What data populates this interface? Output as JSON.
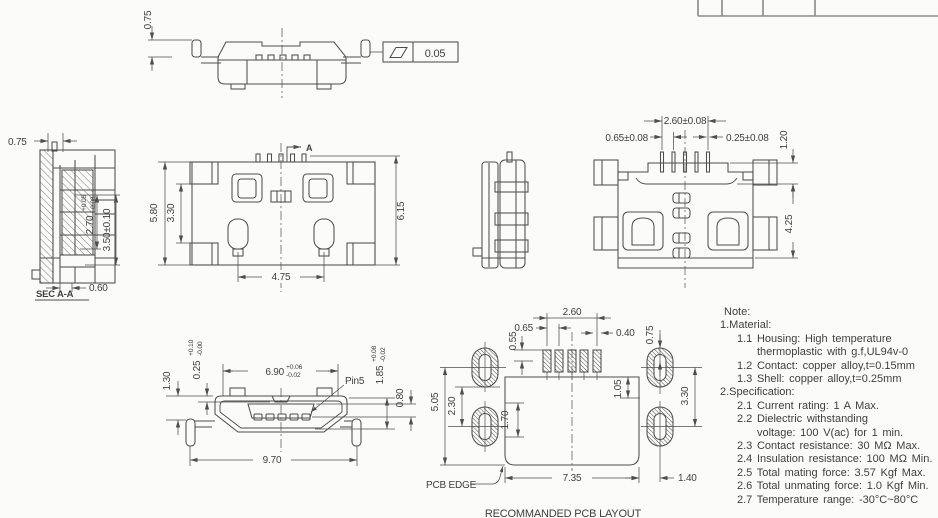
{
  "colors": {
    "background": "#fbfbfa",
    "line": "#4e4e4e",
    "text": "#3f3f3f"
  },
  "views": {
    "front_elevation": {
      "dim_leg_height": "0.75",
      "flatness_value": "0.05"
    },
    "section_aa": {
      "label": "SEC A-A",
      "dim_pin_offset": "0.75",
      "depth": {
        "base": "2.70",
        "plus": "+0.05",
        "minus": "-0.08"
      },
      "dim_height": "3.50±0.10",
      "dim_foot": "0.60"
    },
    "top_view": {
      "section_label": "A",
      "dim_shell_width": "5.80",
      "dim_tab_span": "3.30",
      "dim_overall_depth": "6.15",
      "dim_peg_pitch": "4.75"
    },
    "bottom_view": {
      "dim_pin_span": "2.60±0.08",
      "dim_pin_pitch": "0.65±0.08",
      "dim_pin_width": "0.25±0.08",
      "dim_front_step": "1.20",
      "dim_body_depth": "4.25"
    },
    "front_view": {
      "dim_leg_drop": "1.30",
      "dimple": {
        "base": "0.25",
        "plus": "+0.10",
        "minus": "-0.00"
      },
      "opening": {
        "base": "6.90",
        "plus": "+0.06",
        "minus": "-0.02"
      },
      "pin_label": "Pin5",
      "tongue": {
        "base": "1.85",
        "plus": "+0.08",
        "minus": "-0.02"
      },
      "dim_tongue_height": "0.80",
      "dim_overall_width": "9.70"
    },
    "pcb_layout": {
      "caption": "RECOMMANDED PCB LAYOUT",
      "edge_label": "PCB EDGE",
      "dim_pad_span": "2.60",
      "dim_pad_pitch": "0.65",
      "dim_pad_width": "0.40",
      "dim_pad_inset": "0.55",
      "dim_pad_edge": "0.75",
      "dim_left_span": "5.05",
      "dim_hole_inset": "2.30",
      "dim_cutout_depth": "1.70",
      "dim_pad_row_edge": "1.05",
      "dim_hole_span": "3.30",
      "dim_cutout_width": "7.35",
      "dim_hole_edge": "1.40"
    }
  },
  "notes": {
    "heading": "Note:",
    "lines": [
      {
        "indent": 0,
        "text": "1.Material:"
      },
      {
        "indent": 1,
        "text": "1.1 Housing: High temperature"
      },
      {
        "indent": 2,
        "text": "thermoplastic with g.f,UL94v-0"
      },
      {
        "indent": 1,
        "text": "1.2 Contact: copper alloy,t=0.15mm"
      },
      {
        "indent": 1,
        "text": "1.3 Shell: copper alloy,t=0.25mm"
      },
      {
        "indent": 0,
        "text": "2.Specification:"
      },
      {
        "indent": 1,
        "text": "2.1 Current rating: 1 A Max."
      },
      {
        "indent": 1,
        "text": "2.2 Dielectric withstanding"
      },
      {
        "indent": 2,
        "text": "voltage: 100 V(ac) for 1 min."
      },
      {
        "indent": 1,
        "text": "2.3 Contact resistance: 30 MΩ Max."
      },
      {
        "indent": 1,
        "text": "2.4 Insulation resistance: 100 MΩ Min."
      },
      {
        "indent": 1,
        "text": "2.5 Total mating force: 3.57 Kgf Max."
      },
      {
        "indent": 1,
        "text": "2.6 Total unmating force: 1.0 Kgf Min."
      },
      {
        "indent": 1,
        "text": "2.7 Temperature range: -30°C~80°C"
      }
    ]
  }
}
